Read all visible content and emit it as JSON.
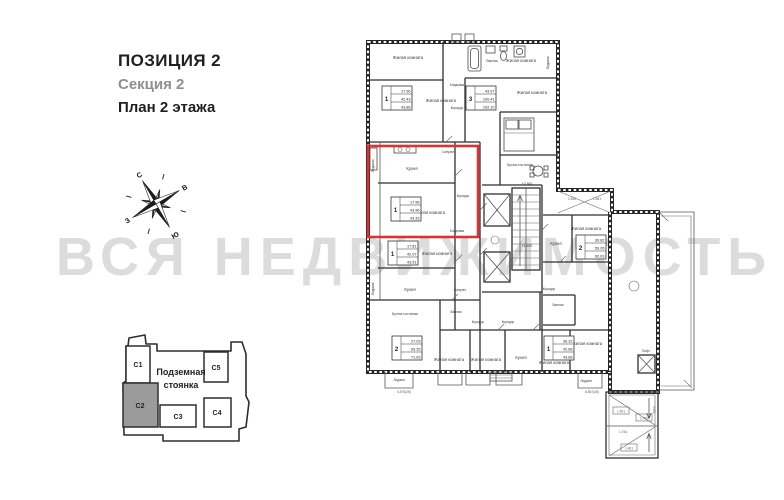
{
  "header": {
    "position": "ПОЗИЦИЯ 2",
    "section": "Секция 2",
    "plan": "План 2 этажа"
  },
  "watermark": "ВСЯ НЕДВИЖИМОСТЬ",
  "compass": {
    "north": "С",
    "east": "В",
    "south": "Ю",
    "west": "З"
  },
  "overview": {
    "parking_line1": "Подземная",
    "parking_line2": "стоянка",
    "highlighted_section": "С2",
    "highlight_color": "#9b9b9b",
    "sections": [
      {
        "label": "С1"
      },
      {
        "label": "С2"
      },
      {
        "label": "С3"
      },
      {
        "label": "С4"
      },
      {
        "label": "С5"
      }
    ]
  },
  "plan": {
    "highlight_color": "#d93434",
    "rooms": [
      {
        "label": "Жилая комната"
      },
      {
        "label": "Ванная"
      },
      {
        "label": "Жилая комната"
      },
      {
        "label": "Лоджия"
      },
      {
        "label": "Кладовая"
      },
      {
        "label": "Жилая комната"
      },
      {
        "label": "Коридор"
      },
      {
        "label": "Жилая комната"
      },
      {
        "label": "Кухня"
      },
      {
        "label": "Санузел"
      },
      {
        "label": "Коридор"
      },
      {
        "label": "Жилая комната"
      },
      {
        "label": "Кладовая"
      },
      {
        "label": "Лоджия"
      },
      {
        "label": "Кухня-гостиная"
      },
      {
        "label": "Жилая комната"
      },
      {
        "label": "Кухня"
      },
      {
        "label": "Санузел"
      },
      {
        "label": "Лоджия"
      },
      {
        "label": "Кухня-гостиная"
      },
      {
        "label": "Лоджия"
      },
      {
        "label": "Жилая комната"
      },
      {
        "label": "Жилая комната"
      },
      {
        "label": "Коридор"
      },
      {
        "label": "Коридор"
      },
      {
        "label": "Ванная"
      },
      {
        "label": "Кухня"
      },
      {
        "label": "Жилая комната"
      },
      {
        "label": "Жилая комната"
      },
      {
        "label": "Лоджия"
      },
      {
        "label": "Кухня"
      },
      {
        "label": "Жилая комната"
      },
      {
        "label": "Ванная"
      },
      {
        "label": "Коридор"
      },
      {
        "label": "Лифт"
      }
    ],
    "tables": [
      {
        "num": "1",
        "a": "17.96",
        "b": "42.43",
        "c": "43.88"
      },
      {
        "num": "3",
        "a": "43.97",
        "b": "100.41",
        "c": "102.10"
      },
      {
        "num": "1",
        "a": "17.96",
        "b": "43.96",
        "c": "43.33"
      },
      {
        "num": "1",
        "a": "17.81",
        "b": "42.07",
        "c": "43.51"
      },
      {
        "num": "2",
        "a": "27.03",
        "b": "69.35",
        "c": "71.63"
      },
      {
        "num": "1",
        "a": "36.32",
        "b": "42.68",
        "c": "43.68"
      },
      {
        "num": "2",
        "a": "30.82",
        "b": "59.05",
        "c": "60.63"
      }
    ],
    "levels": {
      "upper": "+2.800",
      "lower": "+1.400"
    },
    "dims": {
      "loggia_left": "4.570(2б)",
      "loggia_right": "6.867(4б)",
      "wing_a": "1.545",
      "wing_b": "1.561"
    },
    "ramp": {
      "d1": "1.401",
      "d2": "1.744",
      "d3": "1.702",
      "d4": "1.401",
      "slope": "3.6%"
    }
  }
}
